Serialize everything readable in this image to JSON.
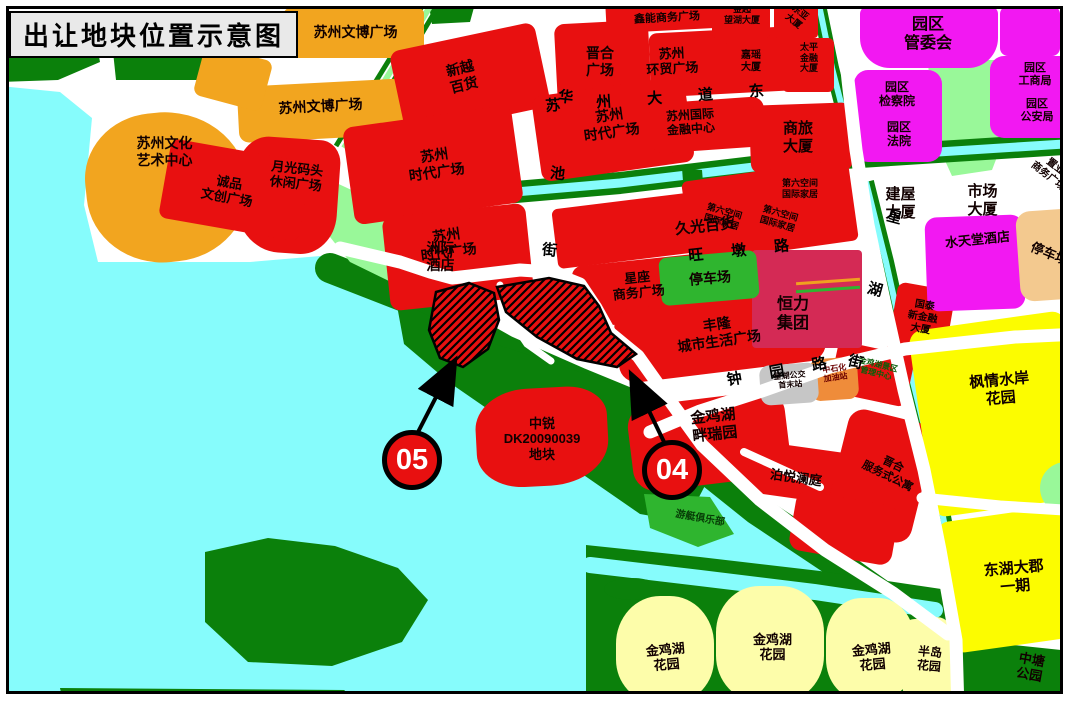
{
  "title": "出让地块位置示意图",
  "roads": {
    "suzhou_avenue_east": "苏州大道东",
    "huachi_street": "华池街",
    "wangdun_road": "旺墩路",
    "xinghu_street": "星湖街",
    "zhongyuan_road": "钟园路"
  },
  "badges": {
    "b05": "05",
    "b04": "04"
  },
  "labels": {
    "wenbo1": "苏州文博广场",
    "wenbo2": "苏州文博广场",
    "arts": "苏州文化\n艺术中心",
    "moonlight": "月光码头\n休闲广场",
    "chengpin": "诚品\n文创广场",
    "xinyue": "新越\n百货",
    "jinhe": "晋合\n广场",
    "xinneng": "鑫能商务广场",
    "huanmao": "苏州\n环贸广场",
    "times_a": "苏州\n时代广场",
    "times_b": "苏州\n时代广场",
    "times_c": "苏州\n时代广场",
    "intl_finance": "苏州国际\n金融中心",
    "shanglv": "商旅\n大厦",
    "jiuguang": "久光百货",
    "interconti": "洲际\n酒店",
    "xingzuo": "星座\n商务广场",
    "fenglong": "丰隆\n城市生活广场",
    "parking_green": "停车场",
    "hengli": "恒力\n集团",
    "sixth1": "第六空间\n国际家居",
    "sixth2": "第六空间\n国际家居",
    "sixth3": "第六空间\n国际家居",
    "wanghu": "金起\n望湖大厦",
    "dongya": "东亚\n大厦",
    "jiayao": "嘉瑶\n大厦",
    "taiping": "太平\n金融\n大厦",
    "guanweihui": "园区\n管委会",
    "jianchayuan": "园区\n检察院",
    "fayuan": "园区\n法院",
    "gongshangju": "园区\n工商局",
    "gonganju": "园区\n公安局",
    "jianwu": "建屋\n大厦",
    "shichang": "市场\n大厦",
    "zhiye": "置业\n商务广场",
    "shuitiantang": "水天堂酒店",
    "parking_tan": "停车场",
    "guotai": "国泰\n新金融\n大厦",
    "fengqing": "枫情水岸\n花园",
    "donghu": "东湖大郡\n一期",
    "zhongtang": "中塘\n公园",
    "bandao": "半岛\n花园",
    "jjh1": "金鸡湖\n花园",
    "jjh2": "金鸡湖\n花园",
    "jjh3": "金鸡湖\n花园",
    "panruiyuan": "金鸡湖\n畔瑞园",
    "boyue": "泊悦澜庭",
    "jinhe_apts": "晋合\n服务式公寓",
    "yacht": "游艇俱乐部",
    "bus": "星湖公交\n首末站",
    "gas": "中石化\n加油站",
    "scenic": "金鸡湖景区\n管理中心",
    "dk": "中锐\nDK20090039\n地块"
  },
  "colors": {
    "red": "#e81010",
    "crimson": "#d42a55",
    "orange": "#f2a51f",
    "magenta": "#f218f2",
    "bright_yellow": "#fcfc00",
    "pale_yellow": "#fdfdaa",
    "dark_green": "#0b800b",
    "mid_green": "#2fb52f",
    "pale_green": "#99f899",
    "water": "#86fcfc",
    "tan": "#f3c98f",
    "gas_orange": "#ef8c3a",
    "gray": "#c6c6c6",
    "line_orange": "#f0a020"
  }
}
